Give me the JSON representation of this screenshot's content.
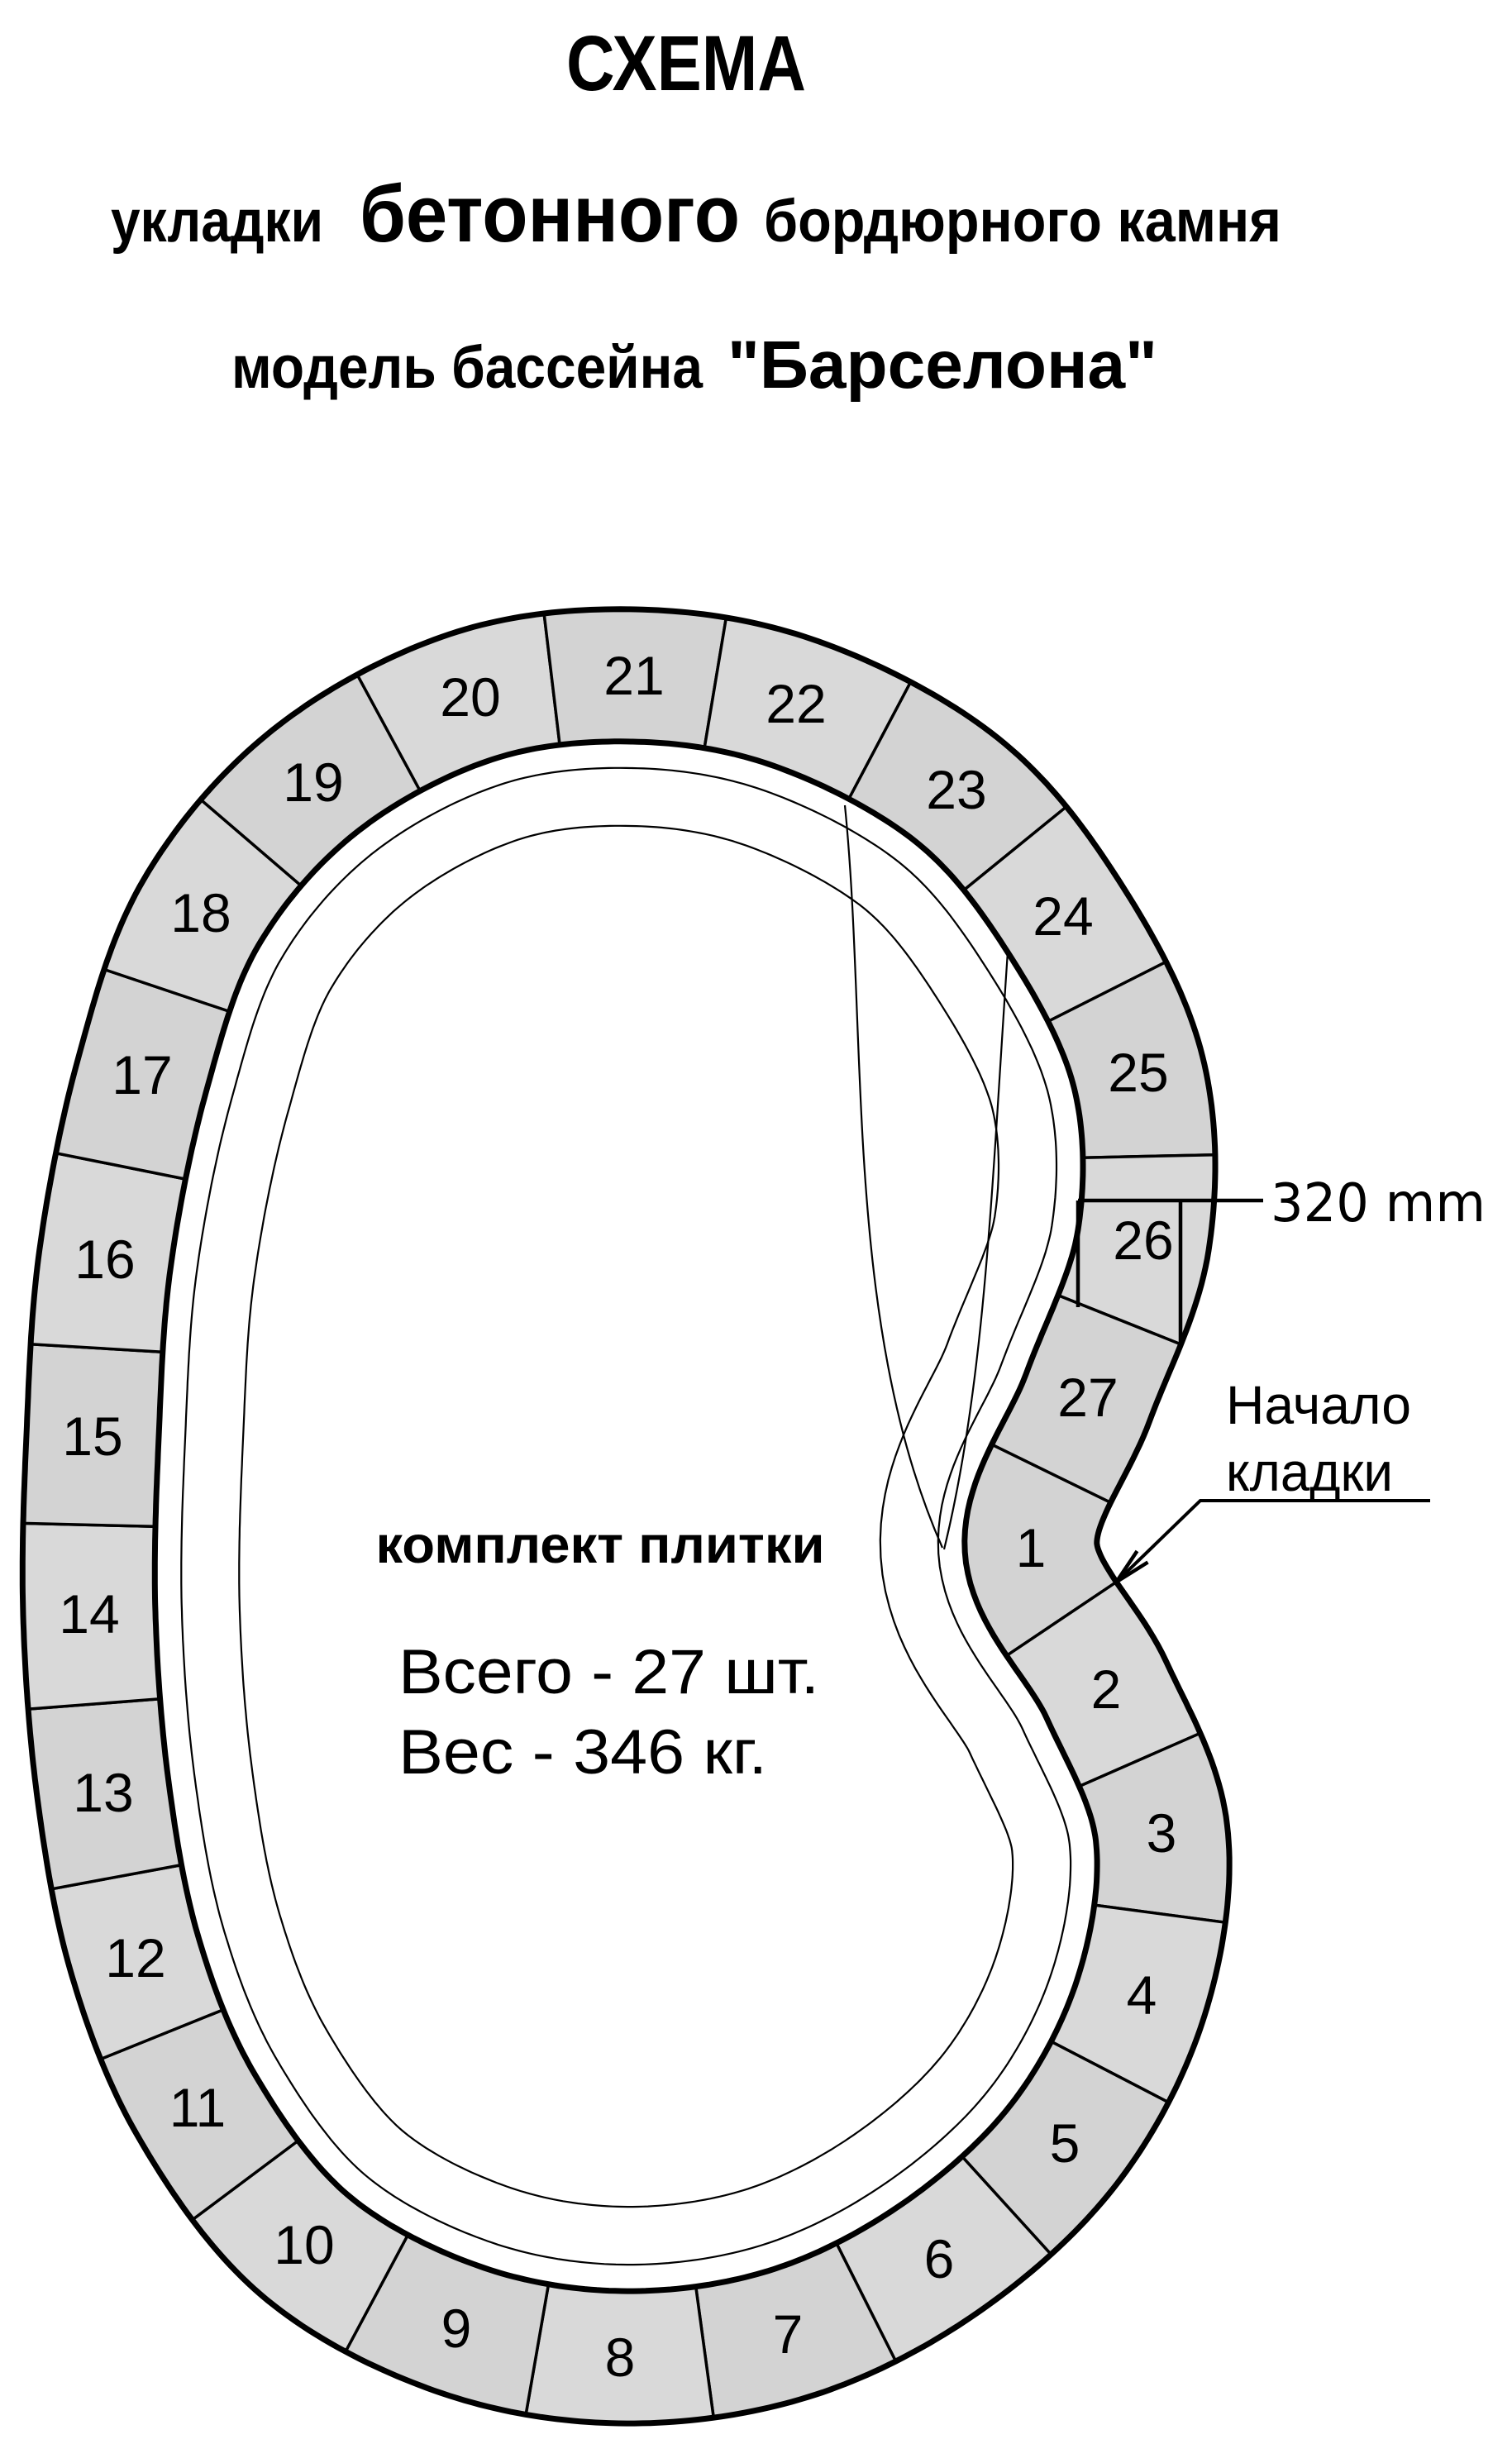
{
  "page_title": "СХЕМА",
  "subtitle": {
    "word1": "укладки",
    "word2": "бетонного",
    "word3": "бордюрного камня"
  },
  "model_line": {
    "prefix": "модель бассейна",
    "name": "\"Барселона\""
  },
  "kit": {
    "heading": "комплект плитки",
    "total": "Всего - 27 шт.",
    "weight": "Вес - 346 кг."
  },
  "dimension": {
    "label": "320 mm"
  },
  "start_note": {
    "line1": "Начало",
    "line2": "кладки"
  },
  "segments": [
    "1",
    "2",
    "3",
    "4",
    "5",
    "6",
    "7",
    "8",
    "9",
    "10",
    "11",
    "12",
    "13",
    "14",
    "15",
    "16",
    "17",
    "18",
    "19",
    "20",
    "21",
    "22",
    "23",
    "24",
    "25",
    "26",
    "27"
  ],
  "colors": {
    "segment_fill_odd": "#d3d3d3",
    "segment_fill_even": "#d9d9d9",
    "outline": "#000000",
    "background": "#ffffff",
    "text": "#000000"
  }
}
